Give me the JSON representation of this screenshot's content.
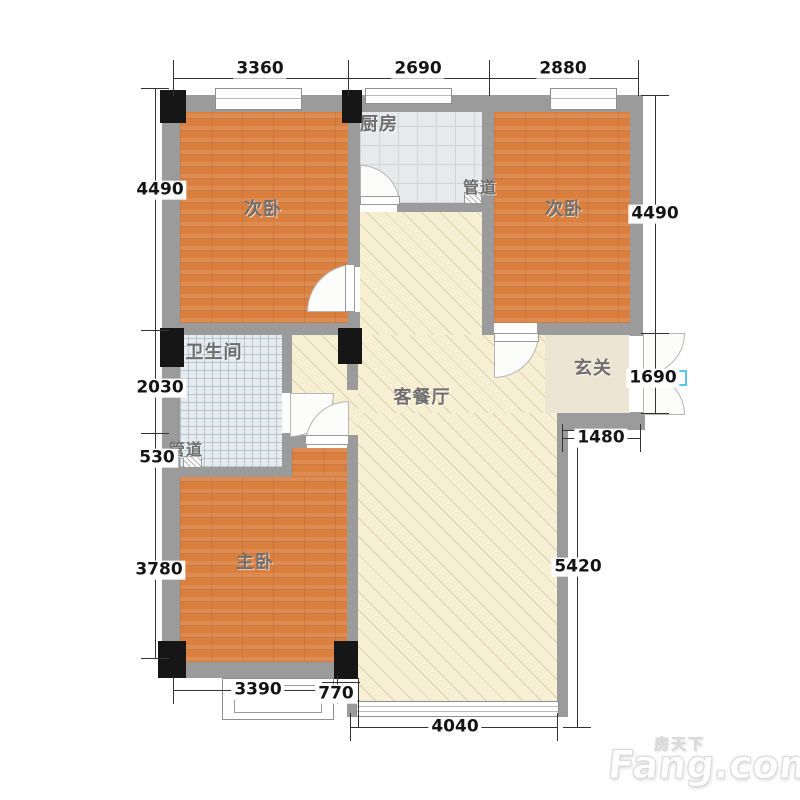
{
  "rooms": {
    "bedroom_left": "次卧",
    "bedroom_right": "次卧",
    "kitchen": "厨房",
    "duct_top": "管道",
    "bathroom": "卫生间",
    "duct_bottom": "管道",
    "living": "客餐厅",
    "entry": "玄关",
    "master": "主卧"
  },
  "dims": {
    "top_left": "3360",
    "top_mid": "2690",
    "top_right": "2880",
    "left_1": "4490",
    "left_2": "2030",
    "left_3": "530",
    "left_4": "3780",
    "right_1": "4490",
    "right_2": "1690",
    "right_3": "5420",
    "inner_1": "1480",
    "bottom_1": "3390",
    "bottom_2": "770",
    "bottom_3": "4040"
  },
  "watermark": {
    "cn": "房天下",
    "en": "Fang.com"
  },
  "colors": {
    "wall": "#9b9b9b",
    "column": "#161616",
    "wood_floor": "#db7f3f",
    "kitchen_tile": "#e8e9ec",
    "bath_tile": "#e5ebee",
    "living_floor": "#f7efd4",
    "entry_floor": "#ede5d3",
    "door_marker_blue": "#58c5ee"
  }
}
